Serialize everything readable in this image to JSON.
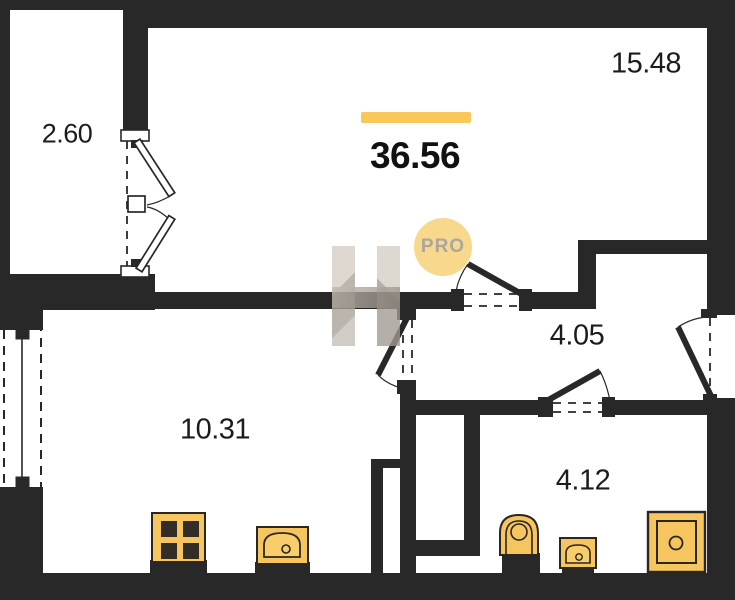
{
  "floorplan": {
    "total_area": "36.56",
    "rooms": [
      {
        "name": "balcony",
        "area": "2.60"
      },
      {
        "name": "living-room",
        "area": "15.48"
      },
      {
        "name": "kitchen",
        "area": "10.31"
      },
      {
        "name": "hallway",
        "area": "4.05"
      },
      {
        "name": "bathroom",
        "area": "4.12"
      }
    ],
    "watermark": {
      "badge_text": "PRO",
      "letter": "H"
    },
    "fixtures": [
      "stove-icon",
      "kitchen-sink-icon",
      "toilet-icon",
      "washbasin-icon",
      "shower-tray-icon"
    ],
    "colors": {
      "wall": "#282828",
      "label_ink": "#1c1c1c",
      "accent_bar": "#F9C85A",
      "fixture_fill": "#F6C55F",
      "fixture_stroke": "#2B2620",
      "pro_badge_bg": "#F8D88C",
      "pro_badge_text": "#ABA69E",
      "watermark_gray": "#B0A99F"
    }
  }
}
